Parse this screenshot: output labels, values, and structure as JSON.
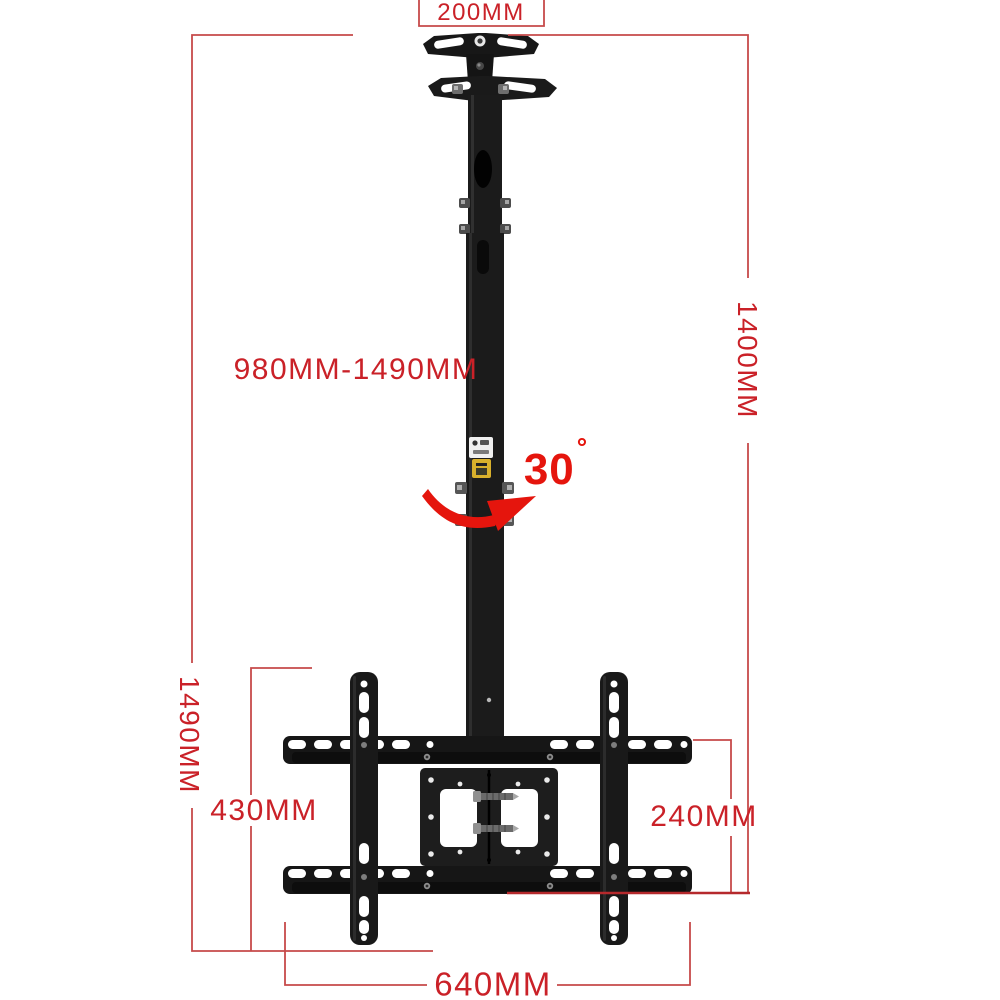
{
  "image": {
    "type": "product-dimension-diagram",
    "subject": "Telescoping ceiling TV mount bracket with dimension callouts"
  },
  "colors": {
    "background": "#ffffff",
    "dimension_line": "#c64a4a",
    "dimension_line_dark": "#b5292c",
    "dimension_text": "#ca2128",
    "accent_red": "#e5150d",
    "hardware_black": "#1a1a1a",
    "hardware_dark": "#0d0d0d",
    "label_yellow": "#d8b02c"
  },
  "dimensions": {
    "top_width": "200MM",
    "drop_height_max": "1400MM",
    "adjustable_range": "980MM-1490MM",
    "rotation_angle": "30",
    "degree_symbol": "°",
    "total_height": "1490MM",
    "bracket_height": "430MM",
    "crossbar_spacing": "240MM",
    "bracket_width": "640MM"
  },
  "icons": {
    "rotation_arrow": "curved-arrow-right"
  }
}
